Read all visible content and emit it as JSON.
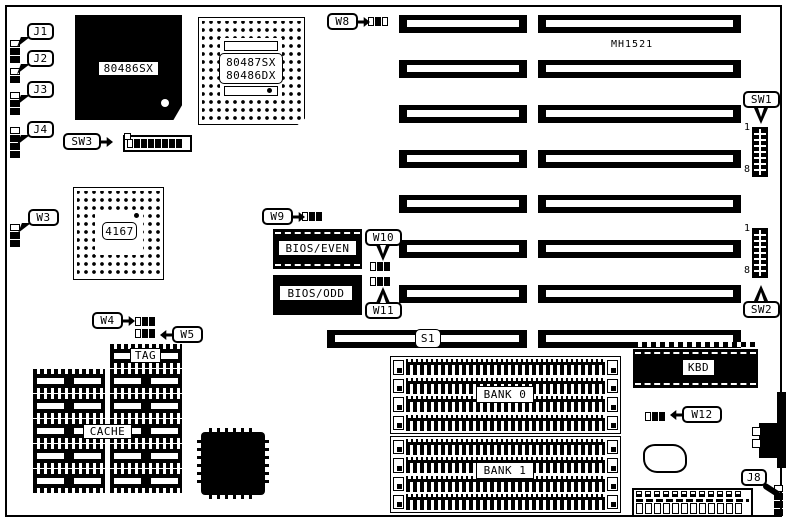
{
  "board": {
    "model": "MH1521"
  },
  "labels": {
    "j1": "J1",
    "j2": "J2",
    "j3": "J3",
    "j4": "J4",
    "j8": "J8",
    "w3": "W3",
    "w4": "W4",
    "w5": "W5",
    "w8": "W8",
    "w9": "W9",
    "w10": "W10",
    "w11": "W11",
    "w12": "W12",
    "sw1": "SW1",
    "sw2": "SW2",
    "sw3": "SW3",
    "s1": "S1"
  },
  "chips": {
    "cpu": "80486SX",
    "fpu_line1": "80487SX",
    "fpu_line2": "80486DX",
    "chipset": "4167",
    "bios_even": "BIOS/EVEN",
    "bios_odd": "BIOS/ODD",
    "tag": "TAG",
    "cache": "CACHE",
    "bank0": "BANK 0",
    "bank1": "BANK 1",
    "kbd": "KBD"
  },
  "switch_pins": {
    "first": "1",
    "last": "8"
  },
  "colors": {
    "ink": "#000000",
    "paper": "#ffffff"
  }
}
